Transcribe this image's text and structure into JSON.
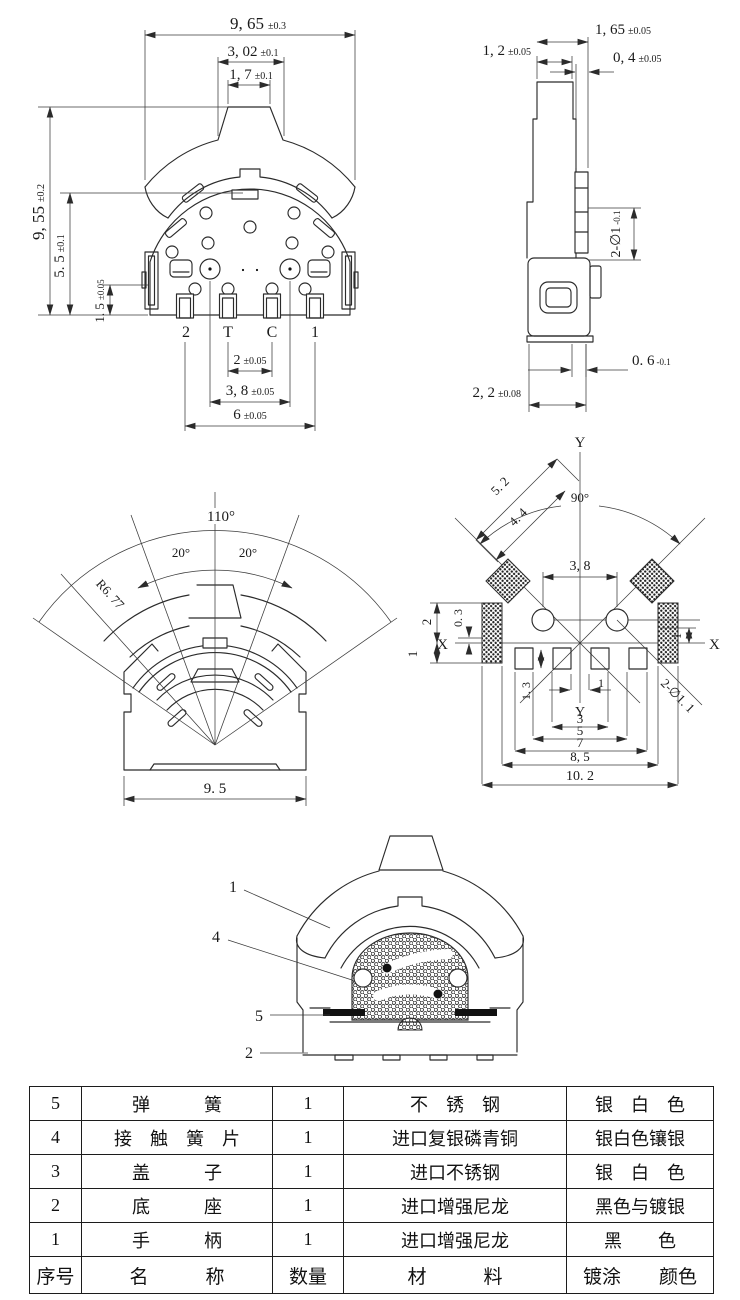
{
  "drawing": {
    "front": {
      "dim_total_w": {
        "v": "9, 65",
        "t": "±0.3"
      },
      "dim_mid_w": {
        "v": "3, 02",
        "t": "±0.1"
      },
      "dim_knob_w": {
        "v": "1, 7",
        "t": "±0.1"
      },
      "dim_total_h": {
        "v": "9, 55",
        "t": "±0.2"
      },
      "dim_body_h": {
        "v": "5. 5",
        "t": "±0.1"
      },
      "dim_pin_h": {
        "v": "1. 5",
        "t": "±0.05"
      },
      "dim_pitch_tc": {
        "v": "2",
        "t": "±0.05"
      },
      "dim_pitch_rivets": {
        "v": "3, 8",
        "t": "±0.05"
      },
      "dim_pitch_outer": {
        "v": "6",
        "t": "±0.05"
      },
      "pin_labels": [
        "2",
        "T",
        "C",
        "1"
      ]
    },
    "side": {
      "dim_knob_w": {
        "v": "1, 2",
        "t": "±0.05"
      },
      "dim_top_w": {
        "v": "1, 65",
        "t": "±0.05"
      },
      "dim_step_w": {
        "v": "0, 4",
        "t": "±0.05"
      },
      "dim_holes": {
        "v": "2-∅1",
        "t": "-0.1"
      },
      "dim_pin_t": {
        "v": "0. 6",
        "t": "-0.1"
      },
      "dim_base_w": {
        "v": "2, 2",
        "t": "±0.08"
      }
    },
    "fan": {
      "angle_total": "110°",
      "angle_left": "20°",
      "angle_right": "20°",
      "radius": "R6. 77",
      "dim_base": "9. 5"
    },
    "footprint": {
      "axis_y_top": "Y",
      "axis_y_bottom": "Y",
      "axis_x_left": "X",
      "axis_x_right": "X",
      "dim_diag_outer": "5. 2",
      "dim_diag_inner": "4. 4",
      "angle": "90°",
      "dim_circle_pitch": "3, 8",
      "dim_pad_above": "2",
      "dim_offset": "0. 3",
      "dim_pad_below": "1",
      "dim_right": "1",
      "dim_pin_h": "1. 3",
      "dim_p1": "1",
      "dim_p3": "3",
      "dim_p5": "5",
      "dim_p7": "7",
      "dim_p85": "8, 5",
      "dim_p102": "10. 2",
      "label_holes": "2-∅1. 1"
    },
    "section": {
      "callout_handle": "1",
      "callout_contact": "4",
      "callout_spring": "5",
      "callout_base": "2"
    }
  },
  "table": {
    "rows": [
      {
        "no": "5",
        "name": "弹　　　簧",
        "qty": "1",
        "material": "不　锈　钢",
        "color": "银　白　色"
      },
      {
        "no": "4",
        "name": "接　触　簧　片",
        "qty": "1",
        "material": "进口复银磷青铜",
        "color": "银白色镶银"
      },
      {
        "no": "3",
        "name": "盖　　　子",
        "qty": "1",
        "material": "进口不锈钢",
        "color": "银　白　色"
      },
      {
        "no": "2",
        "name": "底　　　座",
        "qty": "1",
        "material": "进口增强尼龙",
        "color": "黑色与镀银"
      },
      {
        "no": "1",
        "name": "手　　　柄",
        "qty": "1",
        "material": "进口增强尼龙",
        "color": "黑　　色"
      }
    ],
    "header": {
      "no": "序号",
      "name": "名　　　称",
      "qty": "数量",
      "material": "材　　　料",
      "color": "镀涂　　颜色"
    }
  }
}
